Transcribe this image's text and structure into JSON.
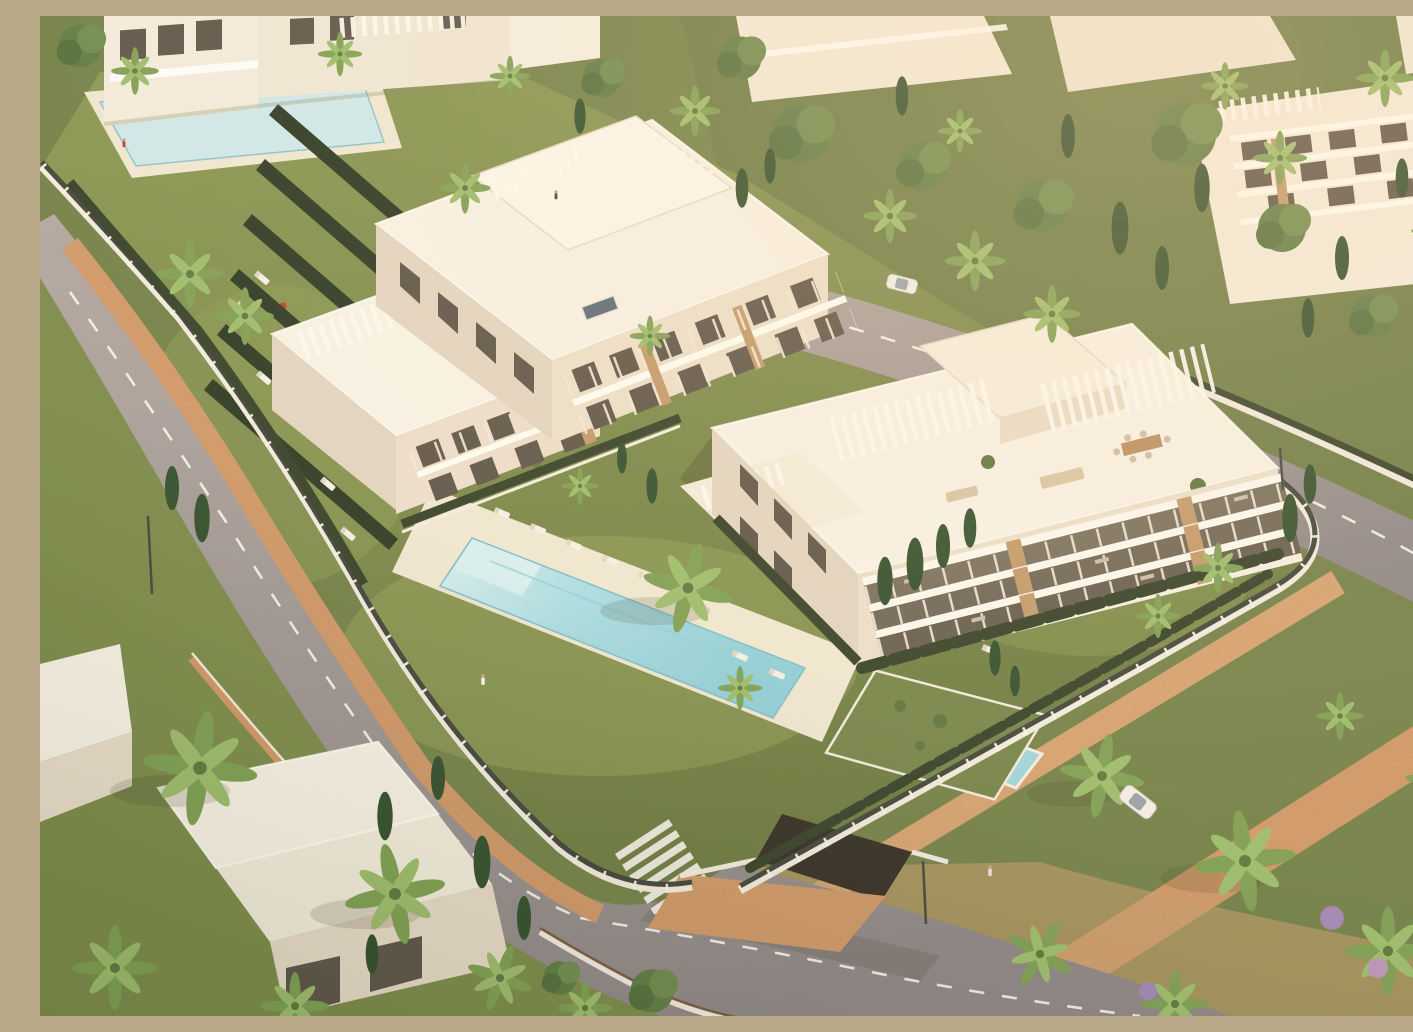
{
  "scene": {
    "description": "Aerial 3D architectural rendering of a modern white apartment complex with rooftop pergola terraces, landscaped gardens, a long swimming pool, perimeter walls, palm-lined curving streets and surrounding residential blocks in warm late-afternoon light",
    "objects": {
      "main_pool": "long rectangular swimming pool with pale turquoise water and white sun deck",
      "kiddie_pool": "small square childrens pool beside the main pool",
      "upper_pool": "second community pool in the upper-left garden with a red parasol",
      "building_a": "stepped white apartment building with rooftop pergolas and solar panel",
      "building_b": "white apartment building with terraced balconies, wood slat screens and roof terrace furniture",
      "villa": "white flat-roofed villa in the lower-left garden",
      "garage": "underground garage entrance with planted green roof",
      "streets": "curving asphalt streets with dashed lane markings, zebra crossings and brick sidewalks",
      "vegetation": "palm trees, cypresses, hedges, lawns and flowering shrubs",
      "figures": "pedestrians walking along the sidewalks",
      "vehicles": "white cars on the streets"
    }
  },
  "palette": {
    "ground_green": "#74824a",
    "lawn": "#7f8e4e",
    "lawn_light": "#9aa75e",
    "hedge_dark": "#36422a",
    "road": "#9b9394",
    "road_light": "#b5aaa4",
    "brick": "#cf9868",
    "brick_light": "#d5a271",
    "sand": "#d9b98c",
    "deck": "#f0e7d2",
    "pool_water": "#9fd6de",
    "pool_shallow": "#d8f0f2",
    "pool_upper": "#cfe9ec",
    "wall_white": "#f1ebdf",
    "fence_dark": "#41463c",
    "building_white": "#f8f2e6",
    "building_cream": "#ece0cb",
    "building_shade": "#e2d5c2",
    "window_dark": "#5f564a",
    "wood_slat": "#c29a6b",
    "green_roof": "#76854b",
    "solar_panel": "#5c6b7a",
    "accent_red": "#c23b2e",
    "car_white": "#f2efe8"
  }
}
